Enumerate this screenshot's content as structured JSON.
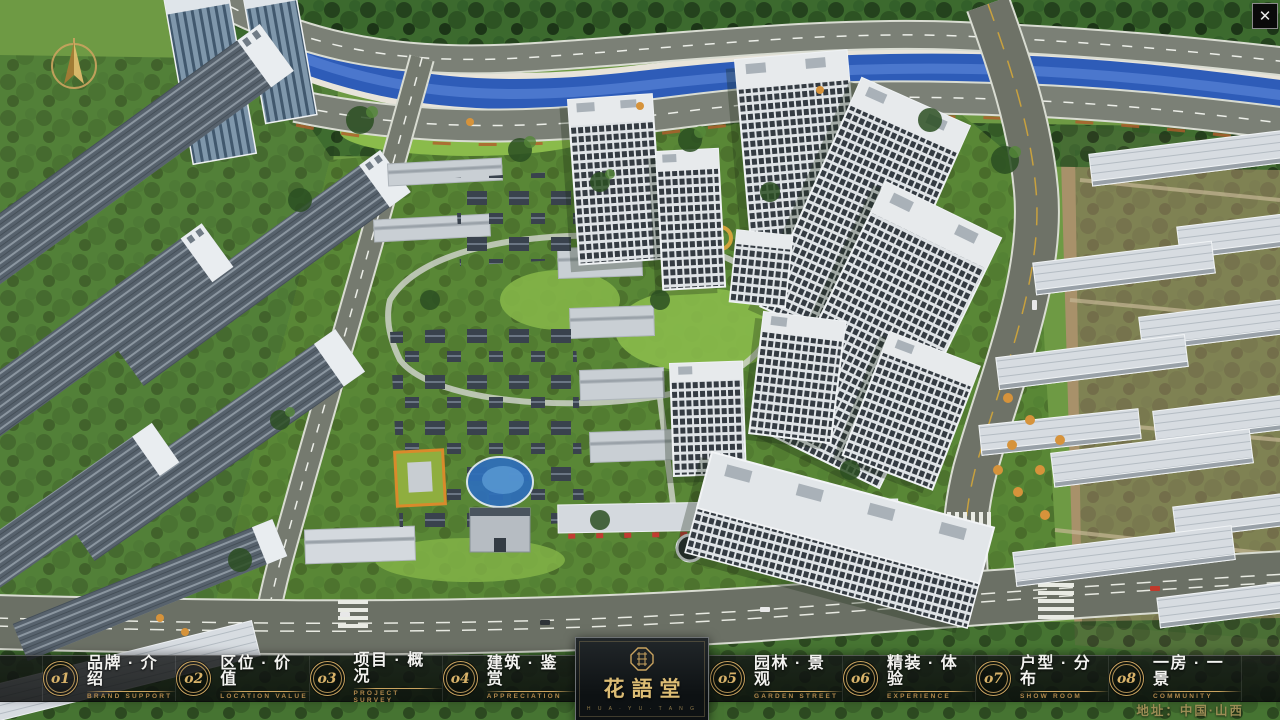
{
  "window": {
    "close_glyph": "✕"
  },
  "nav": {
    "items_left": [
      {
        "num": "o1",
        "zh": "品牌 · 介绍",
        "en": "BRAND SUPPORT"
      },
      {
        "num": "o2",
        "zh": "区位 · 价值",
        "en": "LOCATION VALUE"
      },
      {
        "num": "o3",
        "zh": "项目 · 概况",
        "en": "PROJECT SURVEY"
      },
      {
        "num": "o4",
        "zh": "建筑 · 鉴赏",
        "en": "APPRECIATION"
      }
    ],
    "items_right": [
      {
        "num": "o5",
        "zh": "园林 · 景观",
        "en": "GARDEN STREET"
      },
      {
        "num": "o6",
        "zh": "精装 · 体验",
        "en": "EXPERIENCE"
      },
      {
        "num": "o7",
        "zh": "户型 · 分布",
        "en": "SHOW ROOM"
      },
      {
        "num": "o8",
        "zh": "一房 · 一景",
        "en": "COMMUNITY"
      }
    ]
  },
  "logo": {
    "title": "花語堂",
    "caption": "H U A · Y U · T A N G"
  },
  "footer": {
    "address": "地址：中国·山西"
  },
  "colors": {
    "accent_gold": "#c9a35f",
    "bar_background": "rgba(10,12,12,0.80)",
    "river_blue": "#2e5cb8",
    "address_text": "#9c8d55"
  }
}
